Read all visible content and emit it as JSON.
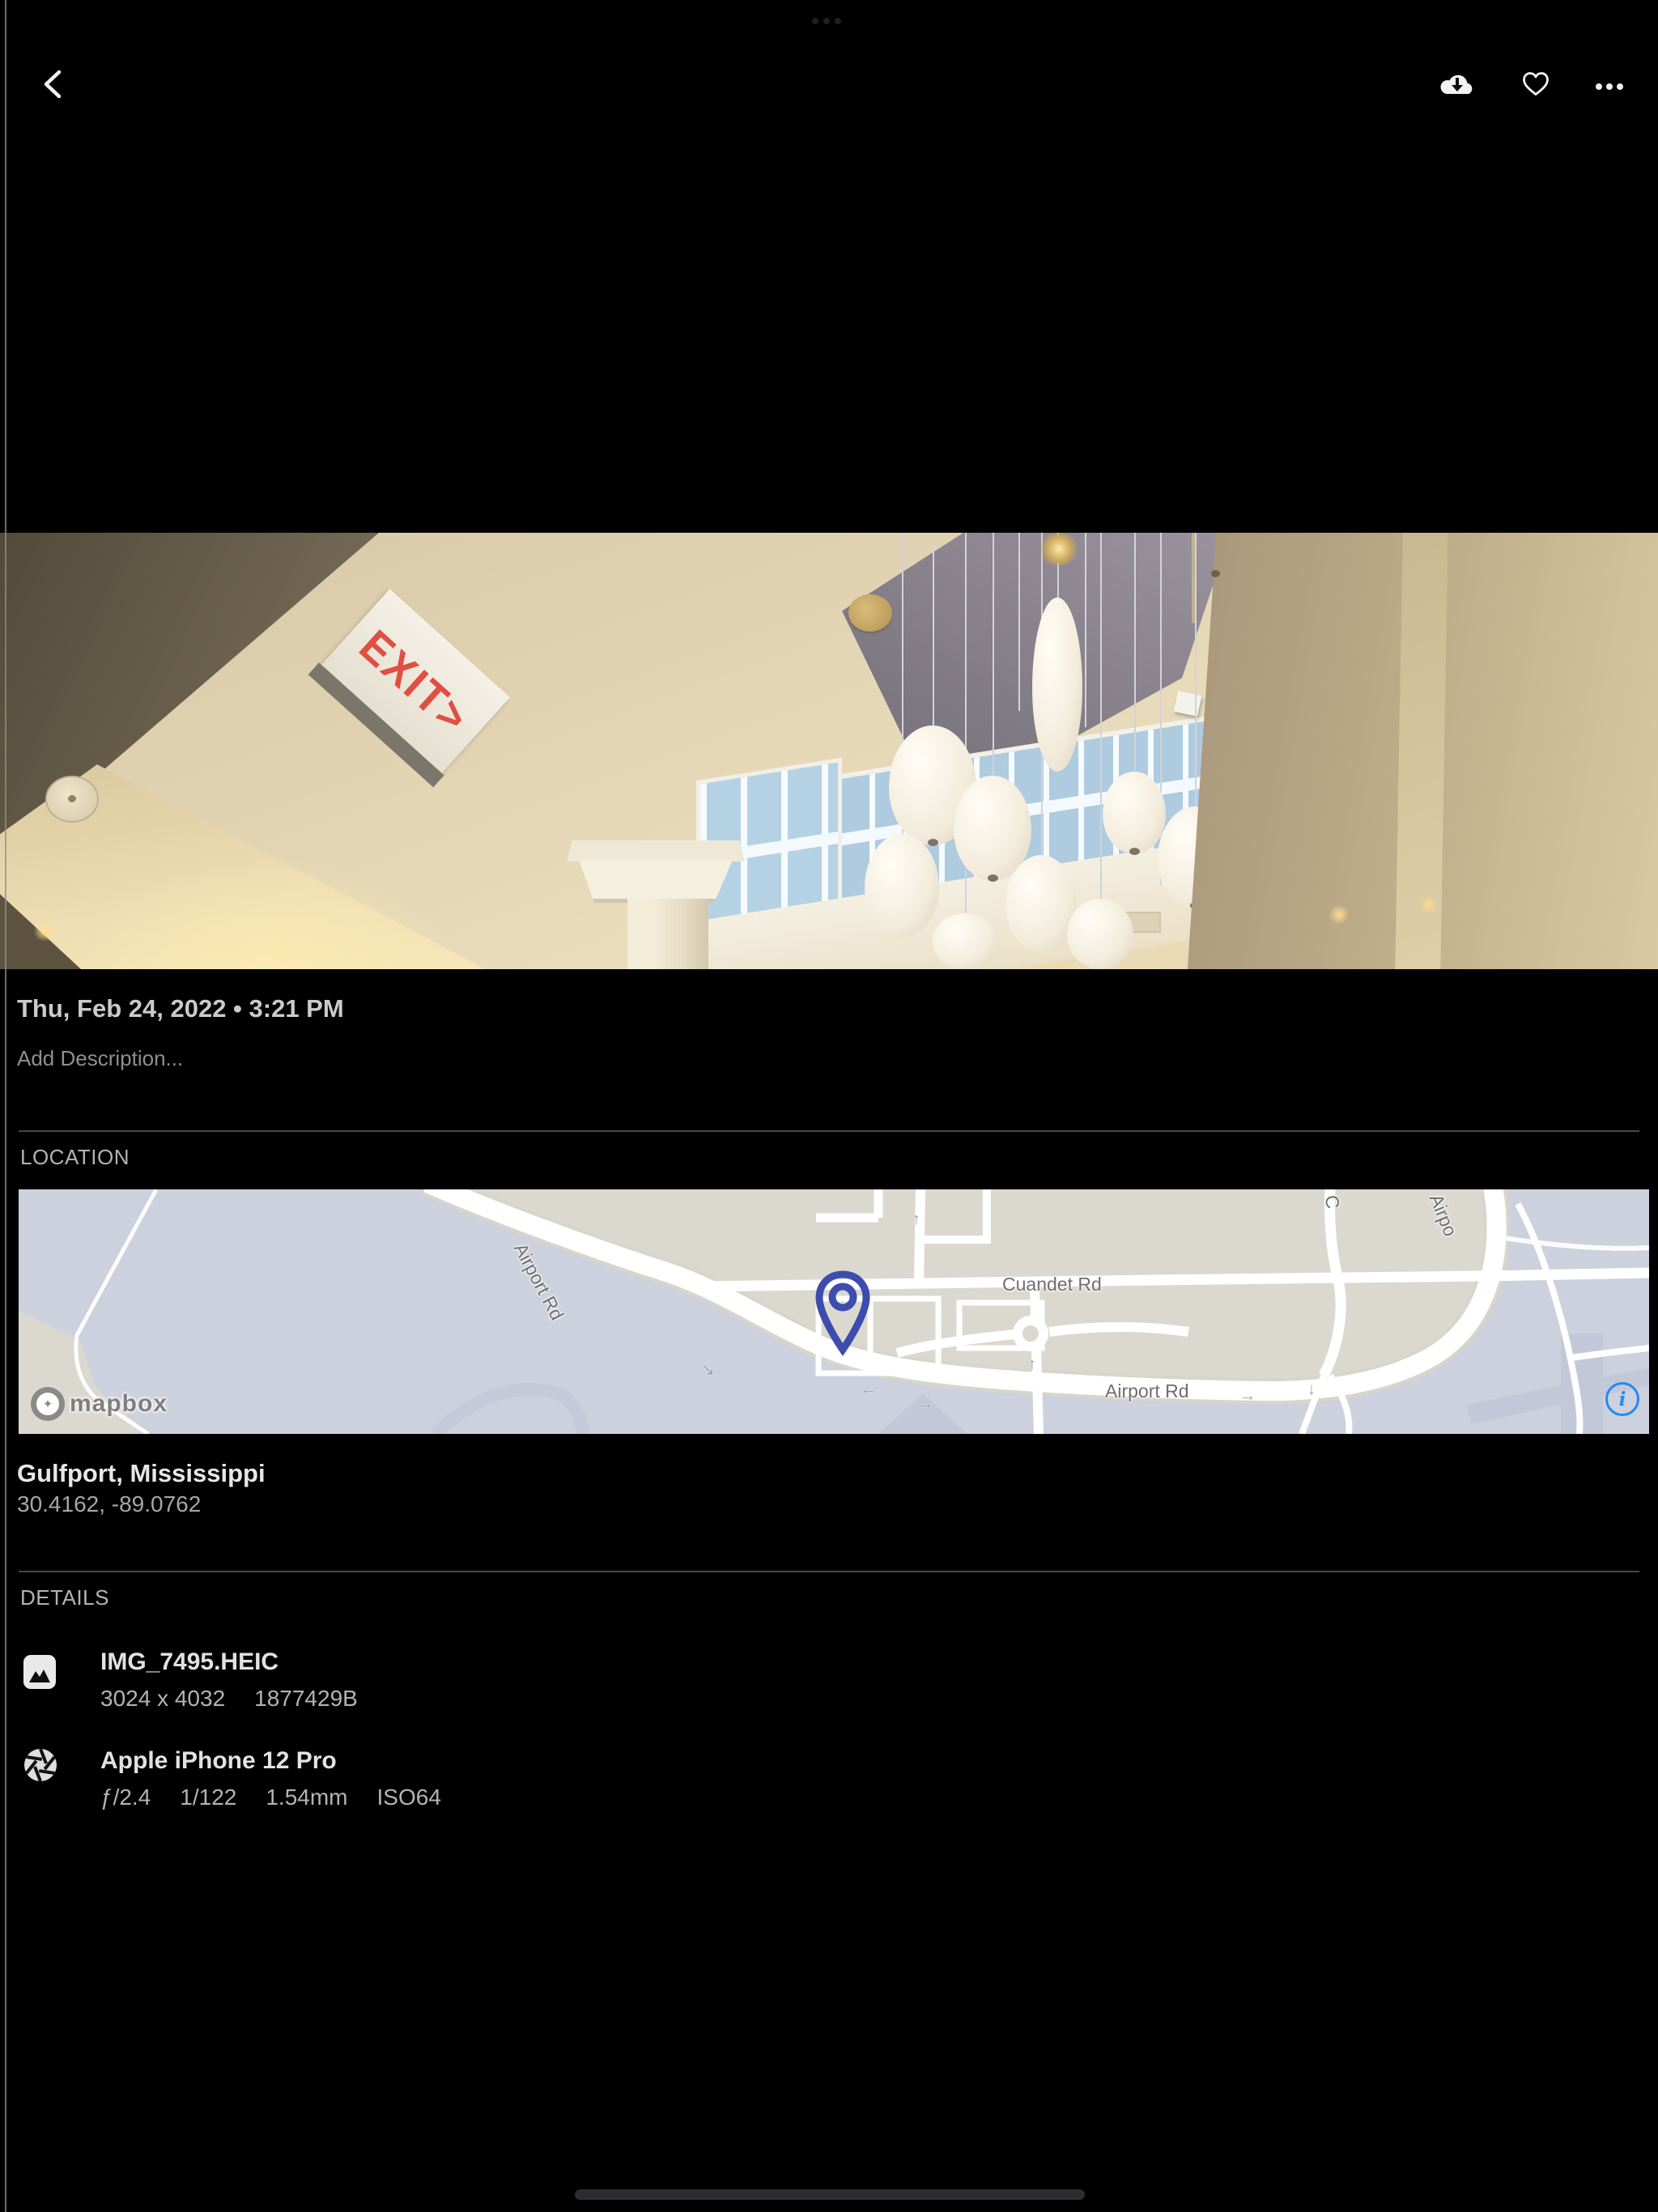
{
  "photo": {
    "exit_sign": "EXIT>"
  },
  "meta": {
    "date": "Thu, Feb 24, 2022 • 3:21 PM",
    "description_placeholder": "Add Description..."
  },
  "location": {
    "title": "LOCATION",
    "place": "Gulfport, Mississippi",
    "coordinates": "30.4162, -89.0762",
    "map": {
      "attribution": "mapbox",
      "logo_star": "✦",
      "info_symbol": "i",
      "labels": {
        "airport_rd_diagonal": "Airport Rd",
        "cuandet_rd": "Cuandet Rd",
        "airport_rd_horizontal": "Airport Rd",
        "partial_c": "C",
        "partial_airport": "Airpo"
      },
      "arrows": {
        "left": "←",
        "right": "→",
        "up": "↑",
        "down": "↓",
        "diag": "↘"
      }
    }
  },
  "details": {
    "title": "DETAILS",
    "file": {
      "name": "IMG_7495.HEIC",
      "dimensions": "3024 x 4032",
      "size": "1877429B"
    },
    "camera": {
      "model": "Apple iPhone 12 Pro",
      "aperture": "ƒ/2.4",
      "shutter": "1/122",
      "focal": "1.54mm",
      "iso": "ISO64"
    }
  }
}
